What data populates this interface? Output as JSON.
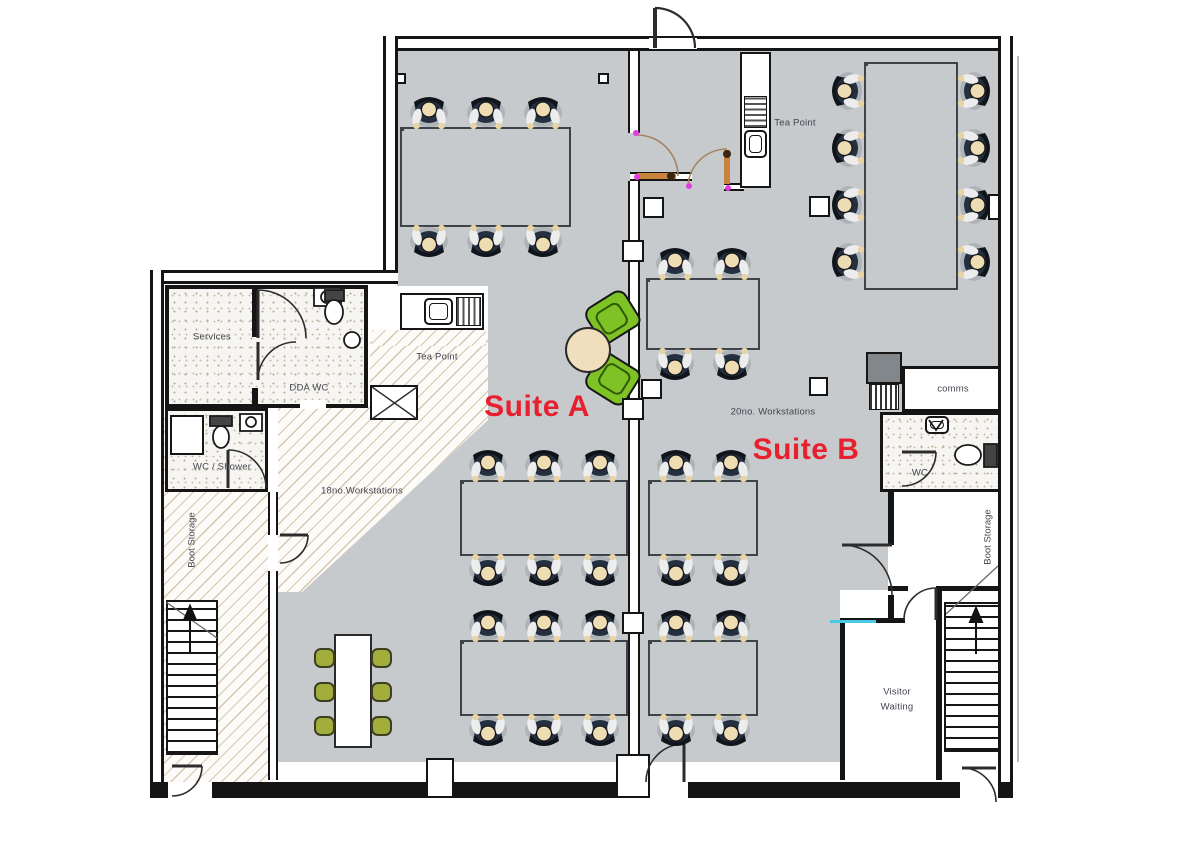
{
  "labels": {
    "suite_a": "Suite A",
    "suite_b": "Suite B",
    "workstations_a": "18no.Workstations",
    "workstations_b": "20no. Workstations",
    "tea_point_a": "Tea Point",
    "tea_point_b": "Tea Point",
    "services": "Services",
    "dda_wc": "DDA WC",
    "wc_shower": "WC / Shower",
    "boot_storage_left": "Boot Storage",
    "boot_storage_right": "Boot Storage",
    "comms": "comms",
    "wc": "WC",
    "visitor_line1": "Visitor",
    "visitor_line2": "Waiting"
  },
  "counts": {
    "suite_a_workstations": 18,
    "suite_b_workstations": 20,
    "meeting_seats": 6,
    "lounge_armchairs": 2,
    "staircases": 2
  },
  "colors": {
    "floor": "#c7cacc",
    "wall": "#151515",
    "suite_label": "#e8202e",
    "lounge_chair": "#7fc226",
    "meeting_chair": "#a2ad3b",
    "table": "#f0dfbc",
    "door_leaf": "#c8833c",
    "door_arc": "#a5835f",
    "hinge_dot": "#e13ce1",
    "glazing": "#49c8e8"
  },
  "clusters": [
    {
      "id": "suite-a-top",
      "x": 400,
      "y": 127,
      "cols": 3,
      "rows": 2,
      "cw": 57,
      "rh": 50,
      "axis": "ns"
    },
    {
      "id": "suite-a-mid",
      "x": 460,
      "y": 480,
      "cols": 3,
      "rows": 2,
      "cw": 56,
      "rh": 38,
      "axis": "ns"
    },
    {
      "id": "suite-a-bottom",
      "x": 460,
      "y": 640,
      "cols": 3,
      "rows": 2,
      "cw": 56,
      "rh": 38,
      "axis": "ns"
    },
    {
      "id": "suite-b-top",
      "x": 646,
      "y": 278,
      "cols": 2,
      "rows": 2,
      "cw": 57,
      "rh": 36,
      "axis": "ns"
    },
    {
      "id": "suite-b-mid",
      "x": 648,
      "y": 480,
      "cols": 2,
      "rows": 2,
      "cw": 55,
      "rh": 38,
      "axis": "ns"
    },
    {
      "id": "suite-b-bottom",
      "x": 648,
      "y": 640,
      "cols": 2,
      "rows": 2,
      "cw": 55,
      "rh": 38,
      "axis": "ns"
    },
    {
      "id": "suite-b-right",
      "x": 864,
      "y": 62,
      "cols": 2,
      "rows": 4,
      "cw": 47,
      "rh": 57,
      "axis": "ew"
    }
  ]
}
